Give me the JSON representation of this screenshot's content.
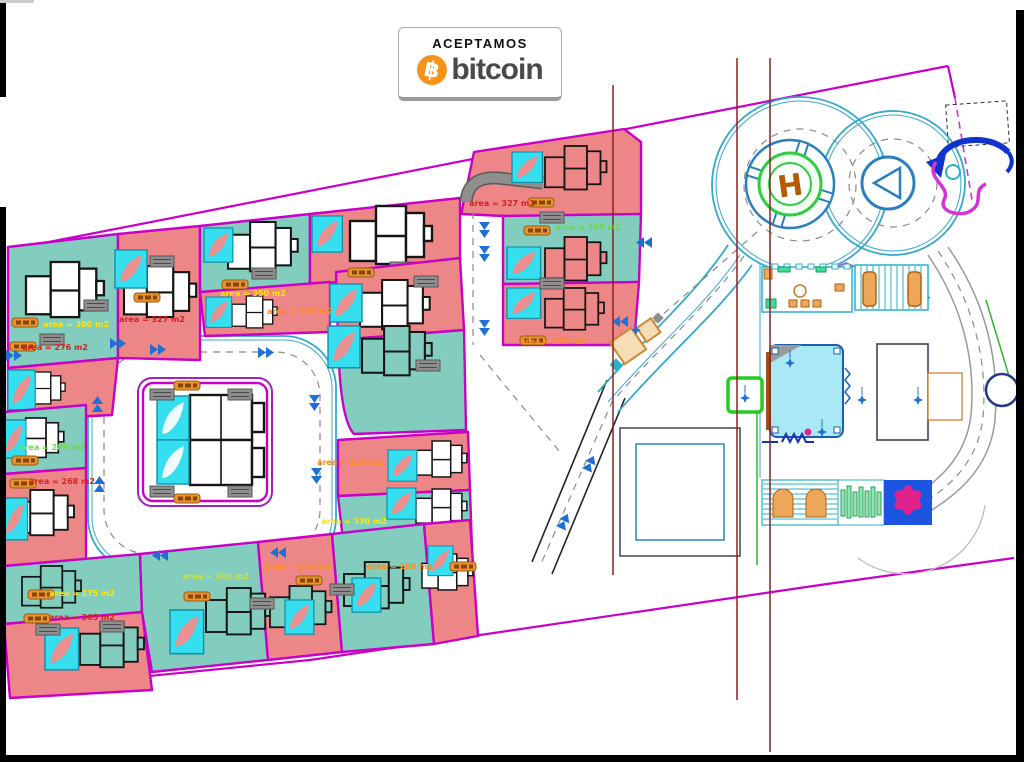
{
  "badge": {
    "line1": "ACEPTAMOS",
    "symbol": "฿",
    "brand": "bitcoin"
  },
  "plan": {
    "helipad_letter": "H",
    "area_labels": {
      "a1": "area = 300 m2",
      "a2": "area = 327 m2",
      "a3": "area = 276 m2",
      "a4": "area = 350 m2",
      "a5": "area = 303 m2",
      "a6": "area = 288 m2",
      "a7": "area = 268 m2",
      "a8": "area = 275 m2",
      "a9": "area = 365 m2",
      "a10": "area = 305 m2",
      "a11": "area = 376 m2",
      "a12": "area = 290 m2",
      "a13": "area = 230 m2",
      "a14": "area = 330 m2",
      "a15": "area = 327 m2",
      "a16": "area = 305 m2",
      "a17": "area = 230 m2"
    },
    "colors": {
      "lot_pink": "#ed8787",
      "lot_teal": "#82cdbd",
      "boundary_magenta": "#c800c8",
      "pool_cyan": "#35dff0",
      "road_edge_teal": "#35a8cc",
      "survey_line_maroon": "#8b2020",
      "helipad_green": "#2ecc40",
      "helipad_h_orange": "#b35900",
      "arrow_blue": "#1f6fd4",
      "lot_tag_orange": "#e8952a",
      "bitcoin_orange": "#f7931a"
    }
  }
}
